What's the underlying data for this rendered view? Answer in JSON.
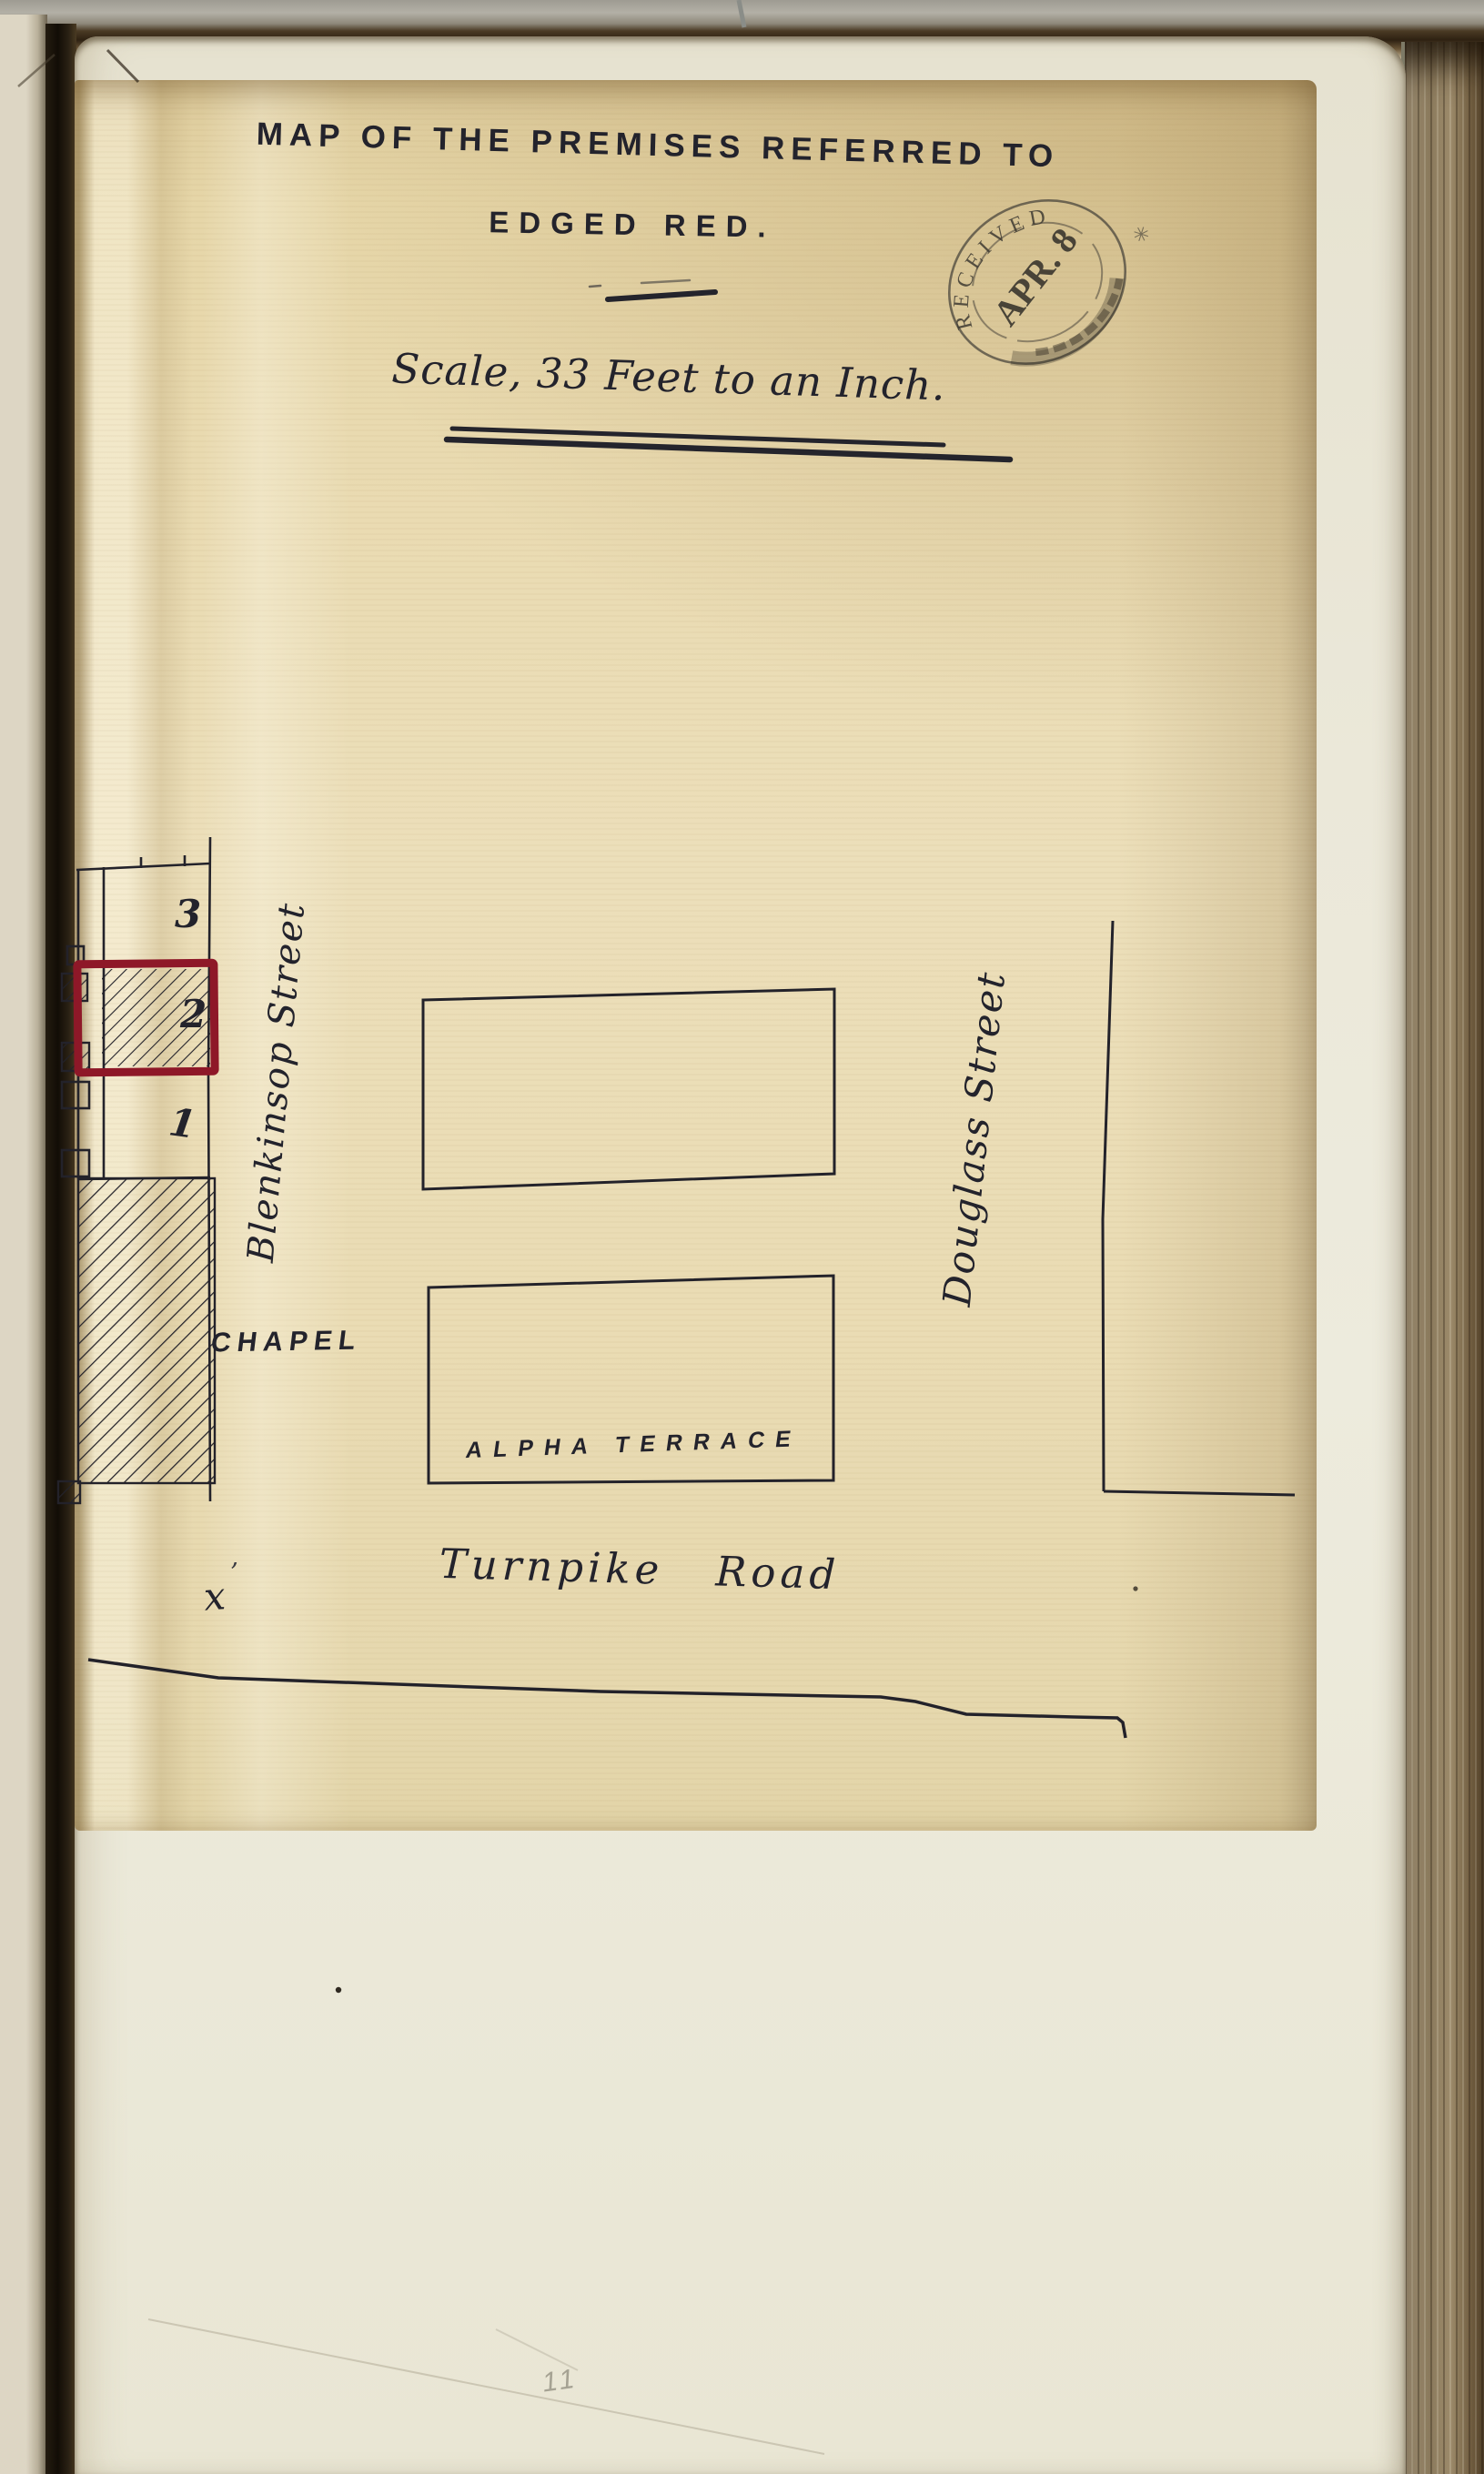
{
  "document": {
    "title_line1": "MAP OF THE PREMISES REFERRED TO",
    "title_line2": "EDGED RED.",
    "scale_text": "Scale, 33 Feet to an Inch.",
    "pencil_page_number": "11"
  },
  "stamp": {
    "arc_text": "RECEIVED",
    "date": "APR. 8",
    "year": "1872",
    "side_mark": "✳"
  },
  "map": {
    "street_west": "Blenkinsop Street",
    "street_east": "Douglass Street",
    "road_south": "Turnpike Road",
    "chapel_label": "CHAPEL",
    "terrace_label": "ALPHA TERRACE",
    "plot_numbers": [
      "3",
      "2",
      "1"
    ],
    "surveyor_mark": "x",
    "surveyor_mark_flourish": "ʼ",
    "colors": {
      "ink": "#24242c",
      "red_edge": "#8e1828",
      "sheet_paper": "#e8d9af",
      "album_page": "#eae7d8"
    }
  }
}
